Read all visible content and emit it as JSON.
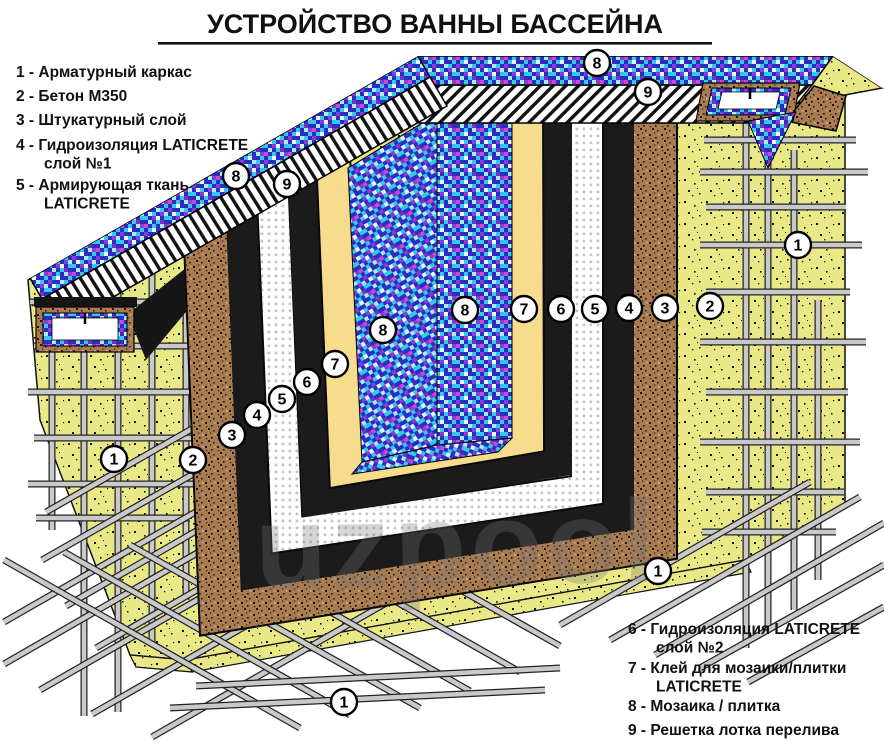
{
  "title": "УСТРОЙСТВО ВАННЫ БАССЕЙНА",
  "watermark": "uzpool",
  "legend_left": {
    "items": [
      {
        "num": "1",
        "lines": [
          "Арматурный каркас"
        ]
      },
      {
        "num": "2",
        "lines": [
          "Бетон М350"
        ]
      },
      {
        "num": "3",
        "lines": [
          "Штукатурный слой"
        ]
      },
      {
        "num": "4",
        "lines": [
          "Гидроизоляция LATICRETE",
          "слой №1"
        ]
      },
      {
        "num": "5",
        "lines": [
          "Армирующая ткань",
          "LATICRETE"
        ]
      }
    ]
  },
  "legend_right": {
    "items": [
      {
        "num": "6",
        "lines": [
          "Гидроизоляция LATICRETE",
          "слой №2"
        ]
      },
      {
        "num": "7",
        "lines": [
          "Клей для мозаики/плитки",
          "LATICRETE"
        ]
      },
      {
        "num": "8",
        "lines": [
          "Мозаика / плитка"
        ]
      },
      {
        "num": "9",
        "lines": [
          "Решетка лотка перелива"
        ]
      }
    ]
  },
  "layers": [
    {
      "num": "1",
      "name": "Арматурный каркас"
    },
    {
      "num": "2",
      "name": "Бетон М350"
    },
    {
      "num": "3",
      "name": "Штукатурный слой"
    },
    {
      "num": "4",
      "name": "Гидроизоляция LATICRETE слой №1"
    },
    {
      "num": "5",
      "name": "Армирующая ткань LATICRETE"
    },
    {
      "num": "6",
      "name": "Гидроизоляция LATICRETE слой №2"
    },
    {
      "num": "7",
      "name": "Клей для мозаики/плитки LATICRETE"
    },
    {
      "num": "8",
      "name": "Мозаика / плитка"
    },
    {
      "num": "9",
      "name": "Решетка лотка перелива"
    }
  ],
  "callouts": [
    {
      "label": "8",
      "x": 236,
      "y": 176
    },
    {
      "label": "9",
      "x": 287,
      "y": 184
    },
    {
      "label": "8",
      "x": 597,
      "y": 63
    },
    {
      "label": "9",
      "x": 648,
      "y": 92
    },
    {
      "label": "3",
      "x": 232,
      "y": 435
    },
    {
      "label": "4",
      "x": 257,
      "y": 415
    },
    {
      "label": "5",
      "x": 282,
      "y": 399
    },
    {
      "label": "6",
      "x": 307,
      "y": 382
    },
    {
      "label": "7",
      "x": 335,
      "y": 364
    },
    {
      "label": "8",
      "x": 383,
      "y": 330
    },
    {
      "label": "8",
      "x": 465,
      "y": 310
    },
    {
      "label": "7",
      "x": 524,
      "y": 309
    },
    {
      "label": "6",
      "x": 561,
      "y": 309
    },
    {
      "label": "5",
      "x": 595,
      "y": 309
    },
    {
      "label": "4",
      "x": 629,
      "y": 308
    },
    {
      "label": "3",
      "x": 665,
      "y": 308
    },
    {
      "label": "2",
      "x": 710,
      "y": 306
    },
    {
      "label": "1",
      "x": 798,
      "y": 245
    },
    {
      "label": "2",
      "x": 193,
      "y": 460
    },
    {
      "label": "1",
      "x": 114,
      "y": 459
    },
    {
      "label": "1",
      "x": 344,
      "y": 702
    },
    {
      "label": "1",
      "x": 658,
      "y": 571
    }
  ],
  "colors": {
    "concrete": "#e9e887",
    "plaster_brown": "#a87c52",
    "waterproof_black": "#1b1b1b",
    "fabric_white": "#ffffff",
    "adhesive_yellow": "#f7dc8e",
    "mosaic_blue": "#2d2dc4",
    "mosaic_cyan": "#34c9e8",
    "rebar_gray": "#c9c9c9"
  }
}
